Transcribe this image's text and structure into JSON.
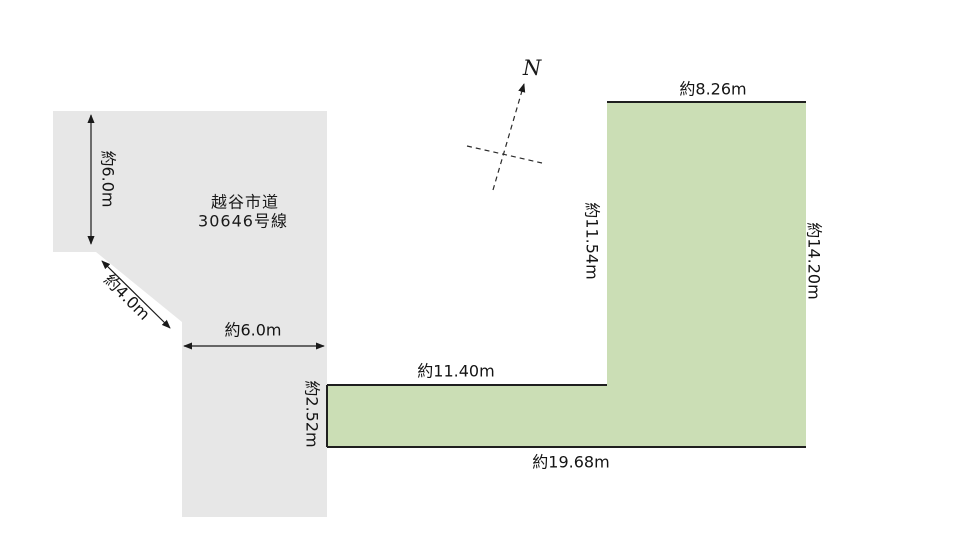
{
  "colors": {
    "background": "#ffffff",
    "road_fill": "#e7e7e7",
    "plot_fill": "#cbdeb5",
    "boundary_line": "#1f1f1f",
    "dimension_line": "#1a1a1a"
  },
  "north": {
    "label": "N"
  },
  "road": {
    "name_line1": "越谷市道",
    "name_line2": "30646号線",
    "dim_west_width": "約6.0m",
    "dim_corner_cut": "約4.0m",
    "dim_south_width": "約6.0m"
  },
  "plot": {
    "dim_north_edge": "約8.26m",
    "dim_west_upper_edge": "約11.54m",
    "dim_east_edge": "約14.20m",
    "dim_step_edge": "約11.40m",
    "dim_west_lower_edge": "約2.52m",
    "dim_south_edge": "約19.68m"
  }
}
